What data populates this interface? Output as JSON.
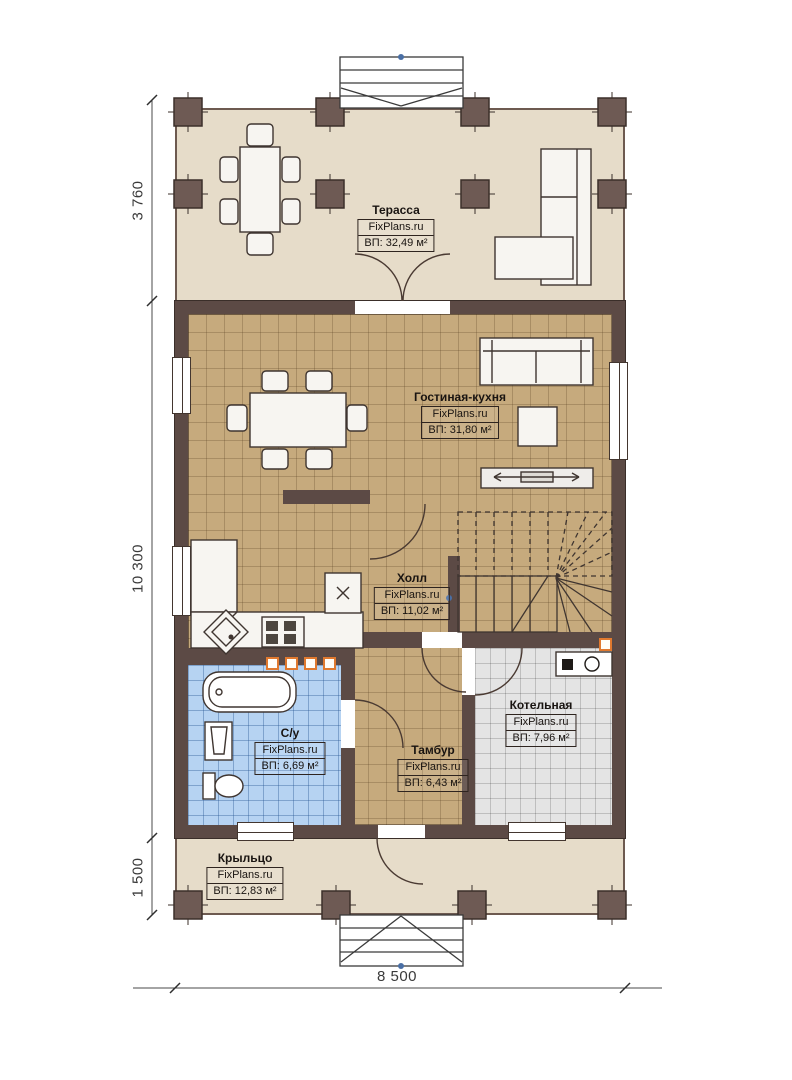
{
  "branding": {
    "site": "FixPlans.ru"
  },
  "rooms": {
    "terrace": {
      "name": "Терасса",
      "area": "ВП: 32,49 м²"
    },
    "living_kitchen": {
      "name": "Гостиная-кухня",
      "area": "ВП: 31,80 м²"
    },
    "hall": {
      "name": "Холл",
      "area": "ВП: 11,02 м²"
    },
    "bathroom": {
      "name": "С/у",
      "area": "ВП: 6,69 м²"
    },
    "vestibule": {
      "name": "Тамбур",
      "area": "ВП: 6,43 м²"
    },
    "boiler_room": {
      "name": "Котельная",
      "area": "ВП: 7,96 м²"
    },
    "porch": {
      "name": "Крыльцо",
      "area": "ВП: 12,83 м²"
    }
  },
  "dimensions": {
    "left_top": "3 760",
    "left_middle": "10 300",
    "left_bottom": "1 500",
    "bottom": "8 500"
  },
  "colors": {
    "wall": "#5c4a45",
    "wood_floor": "#c6aa7d",
    "bath_tile": "#b6d3f2",
    "boiler_tile": "#e4e4e4",
    "deck": "#e6dcc9",
    "accent_orange": "#e0792f"
  }
}
